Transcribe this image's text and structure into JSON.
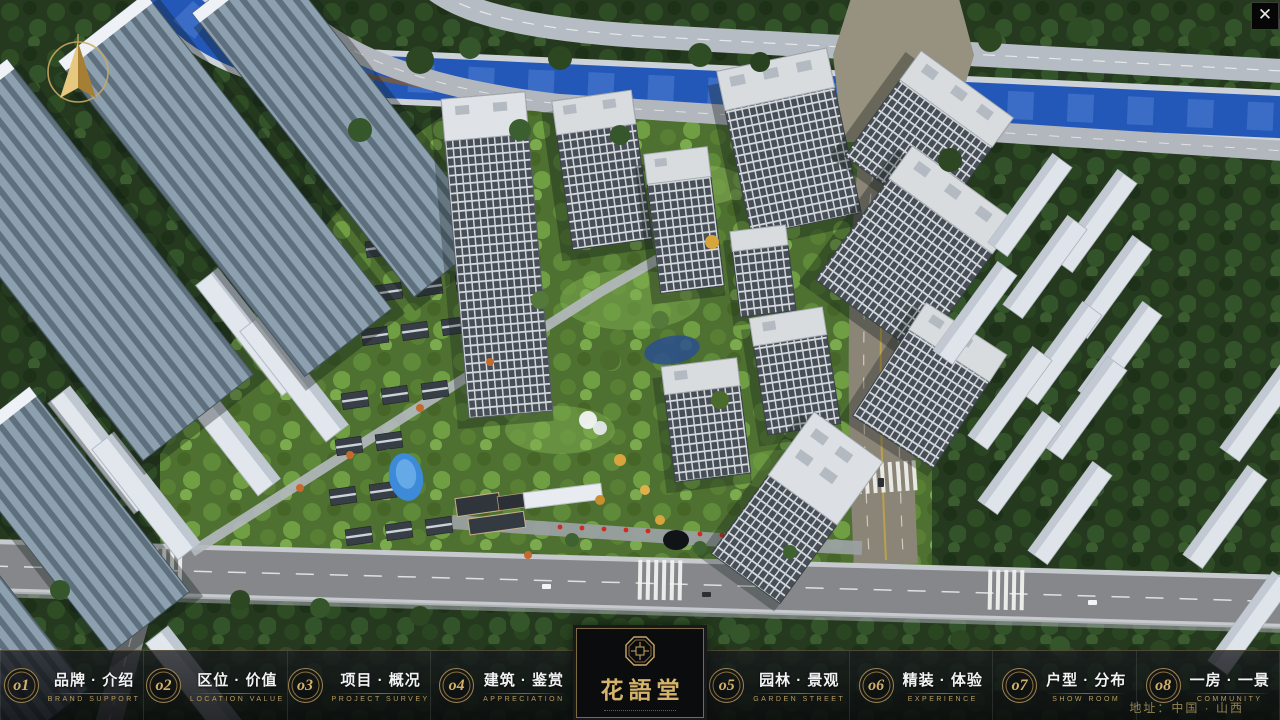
{
  "nav": {
    "items": [
      {
        "num": "o1",
        "zh": "品牌 · 介绍",
        "en": "BRAND SUPPORT"
      },
      {
        "num": "o2",
        "zh": "区位 · 价值",
        "en": "LOCATION VALUE"
      },
      {
        "num": "o3",
        "zh": "项目 · 概况",
        "en": "PROJECT SURVEY"
      },
      {
        "num": "o4",
        "zh": "建筑 · 鉴赏",
        "en": "APPRECIATION"
      },
      {
        "num": "o5",
        "zh": "园林 · 景观",
        "en": "GARDEN STREET"
      },
      {
        "num": "o6",
        "zh": "精装 · 体验",
        "en": "EXPERIENCE"
      },
      {
        "num": "o7",
        "zh": "户型 · 分布",
        "en": "SHOW ROOM"
      },
      {
        "num": "o8",
        "zh": "一房 · 一景",
        "en": "COMMUNITY"
      }
    ]
  },
  "logo": {
    "title": "花語堂"
  },
  "footer": {
    "address": "地址：中国 · 山西"
  },
  "icons": {
    "close_glyph": "✕",
    "compass": "compass-north-arrow"
  },
  "colors": {
    "gold": "#c9a763",
    "bar_bg": "#0c0e11",
    "river": "#2458b8",
    "road": "#85878b"
  }
}
